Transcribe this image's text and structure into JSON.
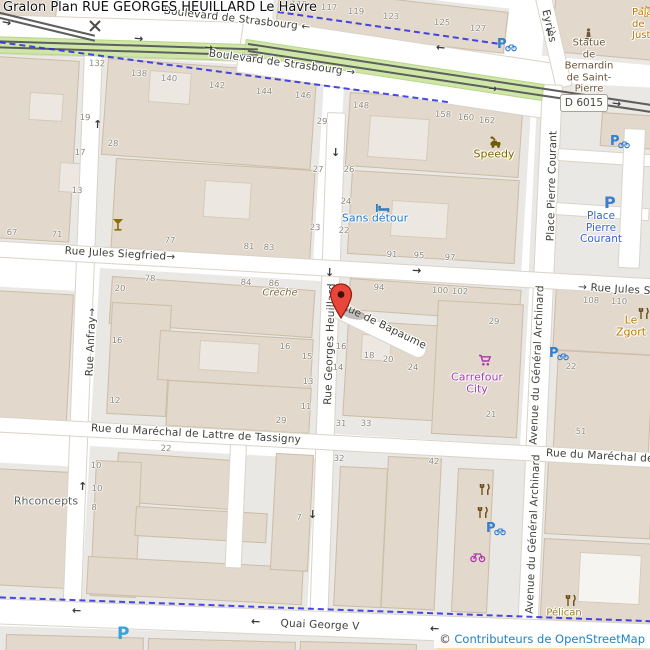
{
  "title": "Gralon Plan RUE GEORGES HEUILLARD Le Havre",
  "attribution": {
    "symbol": "©",
    "text": "Contributeurs de OpenStreetMap"
  },
  "road_shield": "D 6015",
  "colors": {
    "street_label": "#3e3e38",
    "house_number": "#8e887c",
    "cycleway_blue": "#2a2ae0",
    "tram_green": "#cfe7a6",
    "building_tan": "#e2d8cb",
    "block_gray": "#e9e8e5",
    "marker_red": "#e8463a",
    "parking_blue": "#2f7fd2",
    "parking_cyan": "#38a3d6",
    "shop_purple": "#ab37ab",
    "tourism_blue": "#1d76c9",
    "restaurant_brown": "#6b4a12",
    "attribution_blue": "#1d84c6",
    "sand": "#f7ddab"
  },
  "street_labels": [
    {
      "id": "boulevard-strasbourg-1",
      "name": "Boulevard de Strasbourg",
      "suffix": " ←",
      "x": 237,
      "y": 19,
      "rot": 6.5
    },
    {
      "id": "boulevard-strasbourg-2",
      "name": "Boulevard de Strasbourg",
      "suffix": " →",
      "x": 282,
      "y": 63,
      "rot": 7.5
    },
    {
      "id": "rue-jules-siegfried-1",
      "name": "Rue Jules Siegfried",
      "suffix": "→",
      "x": 120,
      "y": 254,
      "rot": 3.3
    },
    {
      "id": "rue-jules-siegfried-2",
      "name": "Rue Jules Siegfried",
      "prefix": "→ ",
      "x": 578,
      "y": 281,
      "rot": 3.3,
      "anchor": "left"
    },
    {
      "id": "rue-anfray",
      "name": "Rue Anfray",
      "suffix": "→",
      "x": 91,
      "y": 342,
      "rot": -87.5
    },
    {
      "id": "rue-georges-heuillard",
      "name": "Rue Georges Heuillard",
      "x": 330,
      "y": 344,
      "rot": -88
    },
    {
      "id": "rue-de-bapaume",
      "name": "Rue de Bapaume",
      "x": 384,
      "y": 326,
      "rot": 26
    },
    {
      "id": "place-pierre-courant-street",
      "name": "Place Pierre Courant",
      "x": 552,
      "y": 186,
      "rot": -88.5
    },
    {
      "id": "avenue-general-archinard-1",
      "name": "Avenue du Général Archinard",
      "x": 537,
      "y": 365,
      "rot": -87.5
    },
    {
      "id": "avenue-general-archinard-2",
      "name": "Avenue du Général Archinard",
      "x": 533,
      "y": 534,
      "rot": -87.5
    },
    {
      "id": "rue-marechal-tassigny-1",
      "name": "Rue du Maréchal de Lattre de Tassigny",
      "x": 196,
      "y": 434,
      "rot": 3.2
    },
    {
      "id": "rue-marechal-tassigny-2",
      "name": "Rue du Maréchal de Lattre de Tassigny",
      "x": 546,
      "y": 447,
      "rot": 3.2,
      "anchor": "left"
    },
    {
      "id": "quai-george-v",
      "name": "Quai George V",
      "x": 320,
      "y": 625,
      "rot": 2.4
    },
    {
      "id": "rue-eyries",
      "name": "Eyriès",
      "x": 549,
      "y": 26,
      "rot": 77
    }
  ],
  "house_numbers": [
    [
      "115",
      299,
      5
    ],
    [
      "117",
      329,
      8
    ],
    [
      "119",
      356,
      12
    ],
    [
      "123",
      391,
      17
    ],
    [
      "125",
      442,
      23
    ],
    [
      "127",
      478,
      29
    ],
    [
      "132",
      97,
      64
    ],
    [
      "138",
      139,
      74
    ],
    [
      "140",
      169,
      79
    ],
    [
      "142",
      217,
      86
    ],
    [
      "144",
      264,
      92
    ],
    [
      "146",
      303,
      96
    ],
    [
      "148",
      361,
      106
    ],
    [
      "158",
      443,
      115
    ],
    [
      "160",
      466,
      118
    ],
    [
      "162",
      487,
      121
    ],
    [
      "19",
      85,
      118
    ],
    [
      "29",
      322,
      122
    ],
    [
      "28",
      113,
      144
    ],
    [
      "17",
      80,
      153
    ],
    [
      "27",
      318,
      170
    ],
    [
      "26",
      349,
      170
    ],
    [
      "24",
      346,
      202
    ],
    [
      "13",
      77,
      191
    ],
    [
      "23",
      315,
      228
    ],
    [
      "22",
      344,
      231
    ],
    [
      "67",
      12,
      233
    ],
    [
      "71",
      57,
      235
    ],
    [
      "77",
      170,
      241
    ],
    [
      "81",
      249,
      247
    ],
    [
      "83",
      269,
      248
    ],
    [
      "91",
      392,
      255
    ],
    [
      "95",
      419,
      256
    ],
    [
      "97",
      450,
      258
    ],
    [
      "78",
      150,
      279
    ],
    [
      "20",
      120,
      289
    ],
    [
      "84",
      246,
      283
    ],
    [
      "86",
      274,
      284
    ],
    [
      "94",
      379,
      288
    ],
    [
      "100",
      440,
      291
    ],
    [
      "102",
      460,
      292
    ],
    [
      "29",
      494,
      322
    ],
    [
      "16",
      117,
      341
    ],
    [
      "12",
      115,
      401
    ],
    [
      "16",
      285,
      347
    ],
    [
      "15",
      307,
      357
    ],
    [
      "14",
      338,
      368
    ],
    [
      "13",
      308,
      382
    ],
    [
      "11",
      306,
      407
    ],
    [
      "16",
      341,
      347
    ],
    [
      "18",
      369,
      356
    ],
    [
      "20",
      388,
      360
    ],
    [
      "24",
      413,
      368
    ],
    [
      "108",
      591,
      301
    ],
    [
      "110",
      619,
      302
    ],
    [
      "22",
      571,
      367
    ],
    [
      "21",
      491,
      415
    ],
    [
      "51",
      581,
      432
    ],
    [
      "29",
      281,
      421
    ],
    [
      "31",
      341,
      424
    ],
    [
      "33",
      366,
      424
    ],
    [
      "22",
      166,
      449
    ],
    [
      "32",
      339,
      459
    ],
    [
      "42",
      434,
      462
    ],
    [
      "10",
      96,
      466
    ],
    [
      "8",
      94,
      508
    ],
    [
      "7",
      299,
      518
    ],
    [
      "10",
      97,
      489
    ]
  ],
  "pois": [
    {
      "id": "speedy",
      "icon": "car-repair",
      "icon_x": 489,
      "icon_y": 134,
      "lines": [
        "Speedy"
      ],
      "x": 494,
      "y": 154,
      "color": "#7e5f00",
      "size": 11
    },
    {
      "id": "sans-detour",
      "icon": "bed",
      "icon_x": 375,
      "icon_y": 199,
      "lines": [
        "Sans détour"
      ],
      "x": 375,
      "y": 218,
      "color": "#1d76c9",
      "size": 11
    },
    {
      "id": "creche",
      "lines": [
        "Crèche"
      ],
      "x": 280,
      "y": 293,
      "color": "#7c6a38",
      "italic": true,
      "size": 10
    },
    {
      "id": "carrefour-city",
      "icon": "shopping-cart",
      "icon_x": 478,
      "icon_y": 352,
      "lines": [
        "Carrefour",
        "City"
      ],
      "x": 477,
      "y": 383,
      "color": "#ab37ab",
      "size": 11
    },
    {
      "id": "le-zgort",
      "icon": "restaurant",
      "icon_x": 638,
      "icon_y": 305,
      "lines": [
        "Le Zgort"
      ],
      "x": 631,
      "y": 326,
      "color": "#c07400",
      "size": 11
    },
    {
      "id": "rhconcepts",
      "lines": [
        "Rhconcepts"
      ],
      "x": 46,
      "y": 501,
      "color": "#5c5c58",
      "size": 11
    },
    {
      "id": "pelican",
      "icon": "restaurant",
      "icon_x": 565,
      "icon_y": 592,
      "lines": [
        "Pélican"
      ],
      "x": 564,
      "y": 613,
      "color": "#9b7b2e",
      "size": 10
    },
    {
      "id": "statue-bernardin",
      "icon": "statue",
      "icon_x": 583,
      "icon_y": 28,
      "lines": [
        "Statue",
        "de Bernardin",
        "de Saint-",
        "Pierre"
      ],
      "x": 589,
      "y": 66,
      "color": "#6b5335",
      "size": 10
    },
    {
      "id": "palais-justice",
      "icon": "scales",
      "icon_x": 640,
      "icon_y": 2,
      "lines": [
        "Palais de",
        "Justice"
      ],
      "x": 632,
      "y": 24,
      "color": "#c07400",
      "size": 10,
      "anchor": "left"
    },
    {
      "id": "place-pierre-courant-parking",
      "lines": [
        "Place Pierre",
        "Courant"
      ],
      "x": 601,
      "y": 228,
      "color": "#3b62c8",
      "size": 10.5
    }
  ],
  "standalone_icons": [
    {
      "icon": "bar",
      "x": 112,
      "y": 216
    },
    {
      "icon": "bike-parking",
      "x": 497,
      "y": 36
    },
    {
      "icon": "bike-parking",
      "x": 610,
      "y": 133
    },
    {
      "icon": "bike-parking",
      "x": 549,
      "y": 345
    },
    {
      "icon": "bike-parking",
      "x": 486,
      "y": 520
    },
    {
      "icon": "restaurant",
      "x": 479,
      "y": 481
    },
    {
      "icon": "restaurant",
      "x": 477,
      "y": 504
    },
    {
      "icon": "bicycle-shop",
      "x": 470,
      "y": 548
    },
    {
      "icon": "rail-crossing",
      "x": 88,
      "y": 18
    }
  ],
  "parking_letters": [
    {
      "id": "parking-place-pierre-courant",
      "x": 604,
      "y": 193,
      "size": 16,
      "color": "#3f7dd0"
    },
    {
      "id": "parking-quai",
      "x": 117,
      "y": 624,
      "size": 17,
      "color": "#38a3d6"
    }
  ],
  "arrows": [
    {
      "glyph": "→",
      "x": 2,
      "y": 16,
      "rot": 12
    },
    {
      "glyph": "→",
      "x": 134,
      "y": 32,
      "rot": 5
    },
    {
      "glyph": "→",
      "x": 204,
      "y": 41,
      "rot": 6
    },
    {
      "glyph": "←",
      "x": 436,
      "y": 41,
      "rot": 6
    },
    {
      "glyph": "→",
      "x": 488,
      "y": 82,
      "rot": 7
    },
    {
      "glyph": "→",
      "x": 612,
      "y": 97,
      "rot": 8
    },
    {
      "glyph": "↑",
      "x": 544,
      "y": 26,
      "rot": -14
    },
    {
      "glyph": "↑",
      "x": 93,
      "y": 118,
      "rot": 2
    },
    {
      "glyph": "↓",
      "x": 331,
      "y": 146,
      "rot": 2
    },
    {
      "glyph": "↓",
      "x": 325,
      "y": 266,
      "rot": 2
    },
    {
      "glyph": "→",
      "x": 412,
      "y": 264,
      "rot": 3
    },
    {
      "glyph": "↑",
      "x": 78,
      "y": 480,
      "rot": 2
    },
    {
      "glyph": "↓",
      "x": 308,
      "y": 508,
      "rot": 2
    },
    {
      "glyph": "←",
      "x": 72,
      "y": 604,
      "rot": 2
    },
    {
      "glyph": "←",
      "x": 251,
      "y": 615,
      "rot": 2
    },
    {
      "glyph": "←",
      "x": 430,
      "y": 622,
      "rot": 2
    }
  ],
  "marker": {
    "x": 341,
    "y": 319
  }
}
